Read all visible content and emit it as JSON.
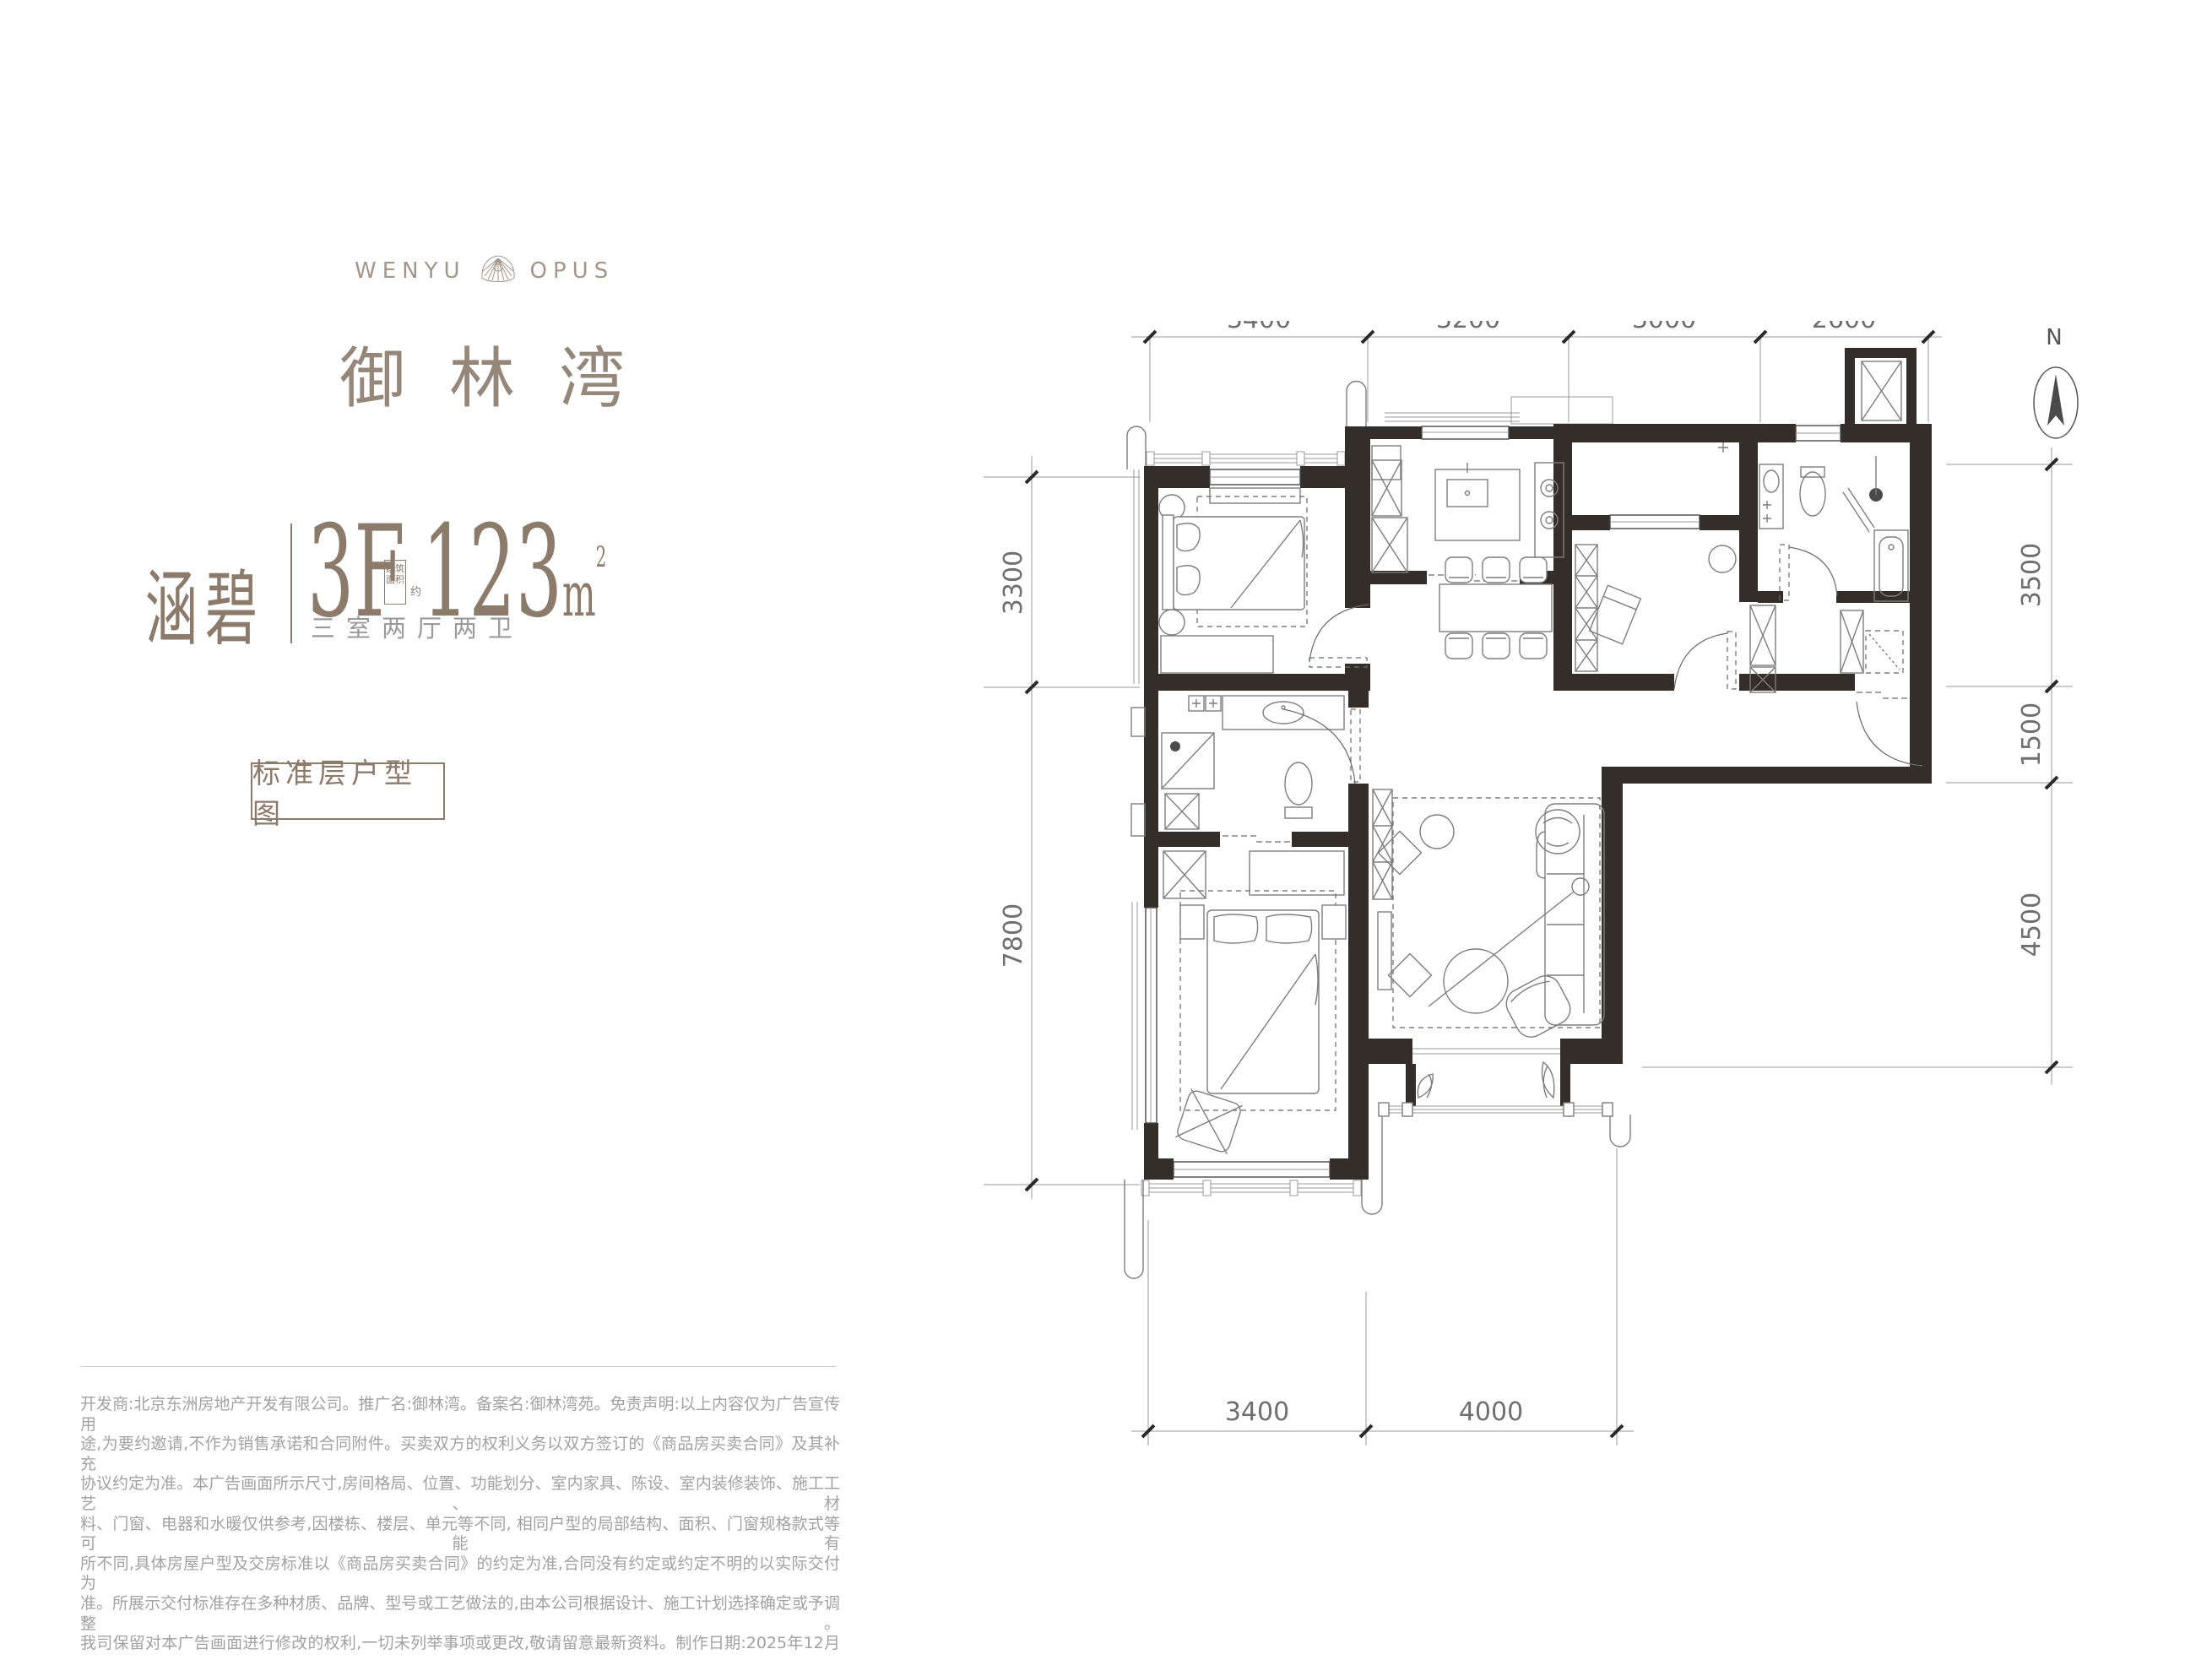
{
  "brand": {
    "logo_left": "WENYU",
    "logo_right": "OPUS",
    "name": "御林湾"
  },
  "unit": {
    "name": "涵碧",
    "floor": "3F",
    "area_box_line1": "建筑",
    "area_box_line2": "面积",
    "area_approx": "约",
    "area_value": "123",
    "area_unit": "m",
    "area_sup": "2",
    "layout": "三室两厅两卫"
  },
  "tag": {
    "label": "标准层户型图"
  },
  "plan": {
    "north_label": "N",
    "dims_top": [
      "3400",
      "3200",
      "3000",
      "2600"
    ],
    "dims_bottom": [
      "3400",
      "4000"
    ],
    "dims_left": [
      "3300",
      "7800"
    ],
    "dims_right": [
      "3500",
      "1500",
      "4500"
    ]
  },
  "disclaimer": {
    "lines": [
      "开发商:北京东洲房地产开发有限公司。推广名:御林湾。备案名:御林湾苑。免责声明:以上内容仅为广告宣传用",
      "途,为要约邀请,不作为销售承诺和合同附件。买卖双方的权利义务以双方签订的《商品房买卖合同》及其补充",
      "协议约定为准。本广告画面所示尺寸,房间格局、位置、功能划分、室内家具、陈设、室内装修装饰、施工工艺、材",
      "料、门窗、电器和水暖仅供参考,因楼栋、楼层、单元等不同, 相同户型的局部结构、面积、门窗规格款式等可能有",
      "所不同,具体房屋户型及交房标准以《商品房买卖合同》的约定为准,合同没有约定或约定不明的以实际交付为",
      "准。所展示交付标准存在多种材质、品牌、型号或工艺做法的,由本公司根据设计、施工计划选择确定或予调整。",
      "我司保留对本广告画面进行修改的权利,一切未列举事项或更改,敬请留意最新资料。制作日期:2025年12月"
    ]
  }
}
